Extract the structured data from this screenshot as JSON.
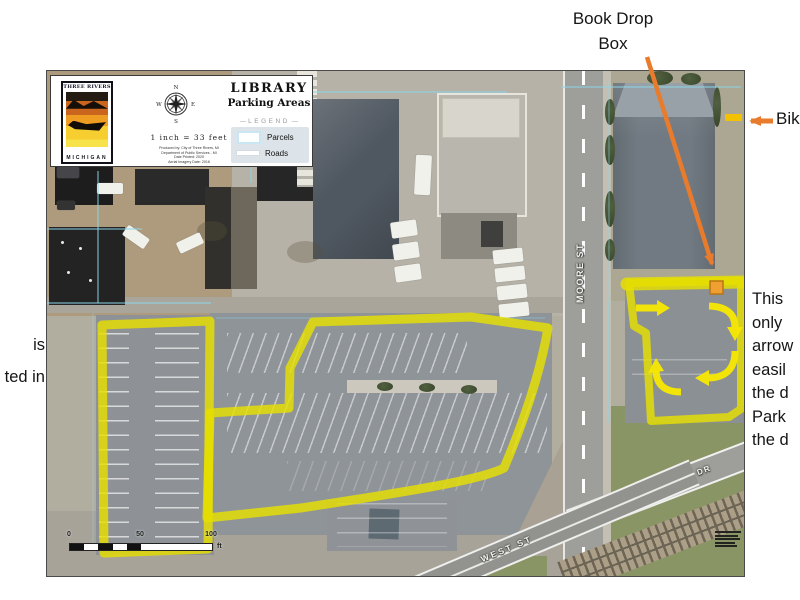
{
  "annotations": {
    "book_drop": {
      "line1": "Book Drop",
      "line2": "Box"
    },
    "bike_fragment": "Bik",
    "right_note_lines": [
      "This",
      "only",
      "arrow",
      "easil",
      "the d",
      "Park",
      "the d"
    ],
    "left_note_lines": [
      "is",
      "ted in"
    ]
  },
  "map_header": {
    "logo_top": "THREE RIVERS",
    "logo_bottom": "MICHIGAN",
    "compass": {
      "n": "N",
      "e": "E",
      "s": "S",
      "w": "W"
    },
    "scale_text": "1 inch = 33 feet",
    "attribution_lines": [
      "Produced by: City of Three Rivers, MI",
      "Department of Public Services - MI",
      "Date Printed: 2020",
      "Aerial Imagery Date: 2016"
    ],
    "title_line1": "LIBRARY",
    "title_line2": "Parking Areas",
    "legend_title": "LEGEND",
    "legend": [
      {
        "label": "Parcels"
      },
      {
        "label": "Roads"
      }
    ]
  },
  "streets": {
    "moore": "MOORE ST",
    "west": "WEST ST",
    "railroad": "RAILROAD DR"
  },
  "scalebar": {
    "tick0": "0",
    "tick50": "50",
    "tick100": "100",
    "unit": "ft"
  },
  "colors": {
    "highlight_yellow": "#e6df00",
    "arrow_yellow": "#f8e800",
    "arrow_orange": "#e87b2c",
    "parcel_blue": "#8cd6e8",
    "book_drop_orange": "#f0a030",
    "bike_marker_yellow": "#f2c200"
  }
}
